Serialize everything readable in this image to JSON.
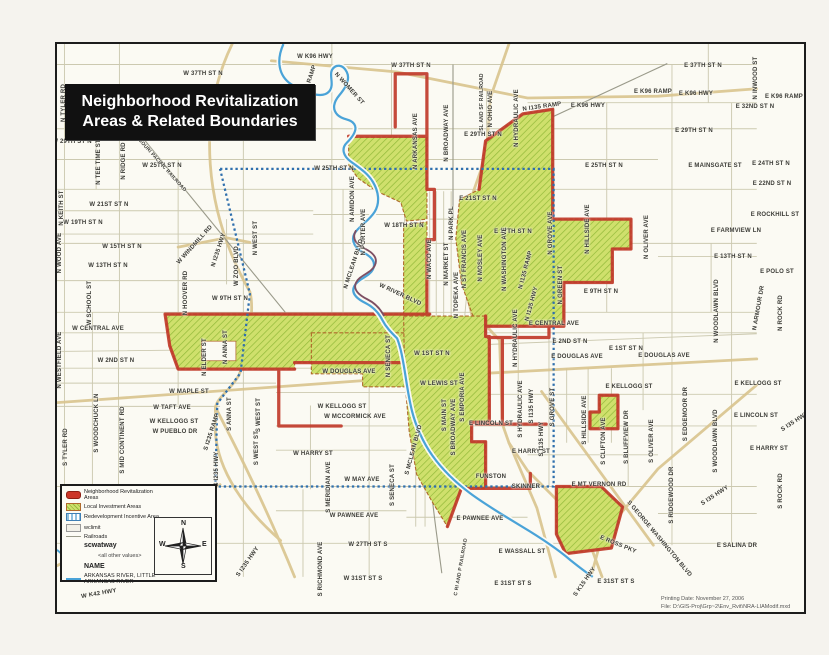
{
  "page": {
    "title_line1": "Neighborhood Revitalization",
    "title_line2": "Areas & Related Boundaries"
  },
  "footer": {
    "line1": "Printing Date: November 27, 2006",
    "line2": "File: D:\\GIS-Proj\\Grp~2\\Env_Rvit\\NRA-LIAModif.mxd"
  },
  "colors": {
    "nra_red": "#c13b2b",
    "lia_green_fill": "#cfe06c",
    "lia_green_hatch": "#96bc3c",
    "ria_blue_dash": "#2f6fad",
    "river_blue": "#4aa3d8",
    "highway_tan": "#d9c48e",
    "railroad_gray": "#9a9a8a"
  },
  "legend": {
    "items": [
      {
        "swatch": "nra",
        "label": "Neighborhood Revitalization Areas"
      },
      {
        "swatch": "lia",
        "label": "Local Investment Areas"
      },
      {
        "swatch": "ria",
        "label": "Redevelopment Incentive Area"
      },
      {
        "swatch": "limit",
        "label": "wclimit"
      },
      {
        "swatch": "rail",
        "label": "Railroads"
      },
      {
        "swatch": "none",
        "label": "scwatway",
        "bold": true
      },
      {
        "swatch": "none",
        "label": "<all other values>",
        "indent": true
      },
      {
        "swatch": "none",
        "label": "NAME",
        "bold": true
      },
      {
        "swatch": "river",
        "label": "ARKANSAS RIVER, LITTLE ARKANSAS RIVER",
        "caps": true
      }
    ],
    "compass": {
      "n": "N",
      "s": "S",
      "e": "E",
      "w": "W"
    }
  },
  "map_labels": [
    {
      "t": "W 37TH ST N",
      "x": 201,
      "y": 72
    },
    {
      "t": "W 37TH ST N",
      "x": 409,
      "y": 64
    },
    {
      "t": "E 37TH ST N",
      "x": 701,
      "y": 64
    },
    {
      "t": "W 29TH ST N",
      "x": 70,
      "y": 140
    },
    {
      "t": "W 29TH ST N",
      "x": 191,
      "y": 138
    },
    {
      "t": "E 29TH ST N",
      "x": 481,
      "y": 133
    },
    {
      "t": "E 29TH ST N",
      "x": 692,
      "y": 129
    },
    {
      "t": "E 32ND ST N",
      "x": 753,
      "y": 105
    },
    {
      "t": "E K96 RAMP",
      "x": 651,
      "y": 90
    },
    {
      "t": "E K96 RAMP",
      "x": 782,
      "y": 95
    },
    {
      "t": "E K96 HWY",
      "x": 694,
      "y": 92
    },
    {
      "t": "E K96 HWY",
      "x": 586,
      "y": 104
    },
    {
      "t": "W K96 HWY",
      "x": 313,
      "y": 55
    },
    {
      "t": "W 25TH ST N",
      "x": 160,
      "y": 164
    },
    {
      "t": "W 25TH ST N",
      "x": 332,
      "y": 167
    },
    {
      "t": "E 25TH ST N",
      "x": 602,
      "y": 164
    },
    {
      "t": "E MAINSGATE ST",
      "x": 713,
      "y": 164
    },
    {
      "t": "E 24TH ST N",
      "x": 769,
      "y": 162
    },
    {
      "t": "E 22ND ST N",
      "x": 770,
      "y": 182
    },
    {
      "t": "E ROCKHILL ST",
      "x": 773,
      "y": 213
    },
    {
      "t": "W 21ST ST N",
      "x": 107,
      "y": 203
    },
    {
      "t": "E 21ST ST N",
      "x": 476,
      "y": 197
    },
    {
      "t": "W 19TH ST N",
      "x": 81,
      "y": 221
    },
    {
      "t": "W 18TH ST N",
      "x": 402,
      "y": 224
    },
    {
      "t": "E 17TH ST N",
      "x": 511,
      "y": 230
    },
    {
      "t": "E FARMVIEW LN",
      "x": 734,
      "y": 229
    },
    {
      "t": "W 15TH ST N",
      "x": 120,
      "y": 245
    },
    {
      "t": "W 13TH ST N",
      "x": 106,
      "y": 264
    },
    {
      "t": "E 13TH ST N",
      "x": 731,
      "y": 255
    },
    {
      "t": "E POLO ST",
      "x": 775,
      "y": 270
    },
    {
      "t": "W 9TH ST N",
      "x": 228,
      "y": 297
    },
    {
      "t": "E 9TH ST N",
      "x": 599,
      "y": 290
    },
    {
      "t": "W CENTRAL AVE",
      "x": 96,
      "y": 327
    },
    {
      "t": "E CENTRAL AVE",
      "x": 552,
      "y": 322
    },
    {
      "t": "W 2ND ST N",
      "x": 114,
      "y": 359
    },
    {
      "t": "E 2ND ST N",
      "x": 568,
      "y": 340
    },
    {
      "t": "W 1ST ST N",
      "x": 430,
      "y": 352
    },
    {
      "t": "E 1ST ST N",
      "x": 624,
      "y": 347
    },
    {
      "t": "W DOUGLAS AVE",
      "x": 347,
      "y": 370
    },
    {
      "t": "E DOUGLAS AVE",
      "x": 575,
      "y": 355
    },
    {
      "t": "E DOUGLAS AVE",
      "x": 662,
      "y": 354
    },
    {
      "t": "W LEWIS ST",
      "x": 437,
      "y": 382
    },
    {
      "t": "W MAPLE ST",
      "x": 187,
      "y": 390
    },
    {
      "t": "W TAFT AVE",
      "x": 170,
      "y": 406
    },
    {
      "t": "W KELLOGG ST",
      "x": 172,
      "y": 420
    },
    {
      "t": "W KELLOGG ST",
      "x": 340,
      "y": 405
    },
    {
      "t": "E KELLOGG ST",
      "x": 627,
      "y": 385
    },
    {
      "t": "E KELLOGG ST",
      "x": 756,
      "y": 382
    },
    {
      "t": "W MCCORMICK AVE",
      "x": 353,
      "y": 415
    },
    {
      "t": "W PUEBLO DR",
      "x": 173,
      "y": 430
    },
    {
      "t": "E LINCOLN ST",
      "x": 489,
      "y": 422
    },
    {
      "t": "E LINCOLN ST",
      "x": 754,
      "y": 414
    },
    {
      "t": "W HARRY ST",
      "x": 311,
      "y": 452
    },
    {
      "t": "E HARRY ST",
      "x": 529,
      "y": 450
    },
    {
      "t": "E HARRY ST",
      "x": 767,
      "y": 447
    },
    {
      "t": "FUNSTON",
      "x": 489,
      "y": 475
    },
    {
      "t": "SKINNER",
      "x": 524,
      "y": 485
    },
    {
      "t": "W MAY AVE",
      "x": 360,
      "y": 478
    },
    {
      "t": "E MT VERNON RD",
      "x": 597,
      "y": 483
    },
    {
      "t": "W PAWNEE AVE",
      "x": 352,
      "y": 514
    },
    {
      "t": "E PAWNEE AVE",
      "x": 478,
      "y": 517
    },
    {
      "t": "W 27TH ST S",
      "x": 366,
      "y": 543
    },
    {
      "t": "E WASSALL ST",
      "x": 520,
      "y": 550
    },
    {
      "t": "E SALINA DR",
      "x": 735,
      "y": 544
    },
    {
      "t": "W 31ST ST S",
      "x": 361,
      "y": 577
    },
    {
      "t": "E 31ST ST S",
      "x": 511,
      "y": 582
    },
    {
      "t": "E 31ST ST S",
      "x": 614,
      "y": 580
    },
    {
      "t": "N TYLER RD",
      "x": 62,
      "y": 101,
      "r": -90
    },
    {
      "t": "N KEITH ST",
      "x": 60,
      "y": 206,
      "r": -90
    },
    {
      "t": "N RIDGE RD",
      "x": 122,
      "y": 159,
      "r": -90
    },
    {
      "t": "N TEE TIME ST",
      "x": 97,
      "y": 160,
      "r": -90
    },
    {
      "t": "N WOOD AVE",
      "x": 58,
      "y": 251,
      "r": -90
    },
    {
      "t": "W SCHOOL ST",
      "x": 88,
      "y": 301,
      "r": -90
    },
    {
      "t": "N WESTFIELD AVE",
      "x": 58,
      "y": 358,
      "r": -90
    },
    {
      "t": "N HOOVER RD",
      "x": 184,
      "y": 291,
      "r": -90
    },
    {
      "t": "W ZOO BLVD",
      "x": 235,
      "y": 264,
      "r": -90
    },
    {
      "t": "N WEST ST",
      "x": 254,
      "y": 236,
      "r": -90
    },
    {
      "t": "S WEST ST",
      "x": 257,
      "y": 413,
      "r": -90
    },
    {
      "t": "S WEST ST",
      "x": 255,
      "y": 446,
      "r": -90
    },
    {
      "t": "N AMIDON AVE",
      "x": 351,
      "y": 197,
      "r": -90
    },
    {
      "t": "N PORTER AVE",
      "x": 362,
      "y": 230,
      "r": -90
    },
    {
      "t": "N ARKANSAS AVE",
      "x": 414,
      "y": 139,
      "r": -90
    },
    {
      "t": "N BROADWAY AVE",
      "x": 445,
      "y": 131,
      "r": -90
    },
    {
      "t": "N WACO AVE",
      "x": 428,
      "y": 257,
      "r": -90
    },
    {
      "t": "N MARKET ST",
      "x": 445,
      "y": 262,
      "r": -90
    },
    {
      "t": "N PARK PL",
      "x": 450,
      "y": 221,
      "r": -90
    },
    {
      "t": "N TOPEKA AVE",
      "x": 455,
      "y": 293,
      "r": -90
    },
    {
      "t": "N ST FRANCIS AVE",
      "x": 463,
      "y": 257,
      "r": -90
    },
    {
      "t": "N MOSLEY AVE",
      "x": 479,
      "y": 256,
      "r": -90
    },
    {
      "t": "N WASHINGTON AVE",
      "x": 503,
      "y": 257,
      "r": -90
    },
    {
      "t": "N OHIO AVE",
      "x": 489,
      "y": 107,
      "r": -90
    },
    {
      "t": "SL AND SF RAILROAD",
      "x": 480,
      "y": 100,
      "r": -90,
      "s": 5
    },
    {
      "t": "N HYDRAULIC AVE",
      "x": 515,
      "y": 116,
      "r": -90
    },
    {
      "t": "N HYDRAULIC AVE",
      "x": 514,
      "y": 336,
      "r": -90
    },
    {
      "t": "S HYDRAULIC AVE",
      "x": 519,
      "y": 407,
      "r": -90
    },
    {
      "t": "N GROVE AVE",
      "x": 549,
      "y": 231,
      "r": -90
    },
    {
      "t": "N GREEN ST",
      "x": 559,
      "y": 283,
      "r": -90
    },
    {
      "t": "N HILLSIDE AVE",
      "x": 586,
      "y": 227,
      "r": -90
    },
    {
      "t": "S HILLSIDE AVE",
      "x": 583,
      "y": 418,
      "r": -90
    },
    {
      "t": "N OLIVER AVE",
      "x": 645,
      "y": 235,
      "r": -90
    },
    {
      "t": "S OLIVER AVE",
      "x": 650,
      "y": 439,
      "r": -90
    },
    {
      "t": "S CLIFTON AVE",
      "x": 602,
      "y": 439,
      "r": -90
    },
    {
      "t": "S BLUFFVIEW DR",
      "x": 625,
      "y": 435,
      "r": -90
    },
    {
      "t": "S EDGEMOOR DR",
      "x": 684,
      "y": 412,
      "r": -90
    },
    {
      "t": "S RIDGEWOOD DR",
      "x": 670,
      "y": 493,
      "r": -90
    },
    {
      "t": "N WOODLAWN BLVD",
      "x": 715,
      "y": 309,
      "r": -90
    },
    {
      "t": "S WOODLAWN BLVD",
      "x": 714,
      "y": 439,
      "r": -90
    },
    {
      "t": "N ARMOUR DR",
      "x": 757,
      "y": 306,
      "r": -80
    },
    {
      "t": "N ROCK RD",
      "x": 779,
      "y": 311,
      "r": -90
    },
    {
      "t": "S ROCK RD",
      "x": 779,
      "y": 489,
      "r": -90
    },
    {
      "t": "N INWOOD ST",
      "x": 754,
      "y": 76,
      "r": -90
    },
    {
      "t": "S MERIDIAN AVE",
      "x": 327,
      "y": 485,
      "r": -90
    },
    {
      "t": "S RICHMOND AVE",
      "x": 319,
      "y": 567,
      "r": -90
    },
    {
      "t": "S SENECA ST",
      "x": 391,
      "y": 483,
      "r": -90
    },
    {
      "t": "N SENECA ST",
      "x": 387,
      "y": 354,
      "r": -90
    },
    {
      "t": "S MAIN ST",
      "x": 443,
      "y": 413,
      "r": -90
    },
    {
      "t": "S BROADWAY AVE",
      "x": 452,
      "y": 425,
      "r": -90
    },
    {
      "t": "S EMPORIA AVE",
      "x": 461,
      "y": 395,
      "r": -90
    },
    {
      "t": "S MCLEAN BLVD",
      "x": 412,
      "y": 448,
      "r": -75
    },
    {
      "t": "N MCLEAN BLVD",
      "x": 352,
      "y": 262,
      "r": -72
    },
    {
      "t": "N ELDER ST",
      "x": 203,
      "y": 355,
      "r": -90
    },
    {
      "t": "N ANNA ST",
      "x": 224,
      "y": 345,
      "r": -90
    },
    {
      "t": "S ANNA ST",
      "x": 228,
      "y": 412,
      "r": -90
    },
    {
      "t": "S MID CONTINENT RD",
      "x": 121,
      "y": 438,
      "r": -90
    },
    {
      "t": "S WOODCHUCK LN",
      "x": 95,
      "y": 421,
      "r": -90
    },
    {
      "t": "S TYLER RD",
      "x": 64,
      "y": 445,
      "r": -90
    },
    {
      "t": "S I235 HWY",
      "x": 215,
      "y": 467,
      "r": -90
    },
    {
      "t": "S I235 RAMP",
      "x": 210,
      "y": 430,
      "r": -72
    },
    {
      "t": "S I235 HWY",
      "x": 246,
      "y": 560,
      "r": -55
    },
    {
      "t": "S I135 HWY",
      "x": 530,
      "y": 404,
      "r": -90
    },
    {
      "t": "S I135 HWY",
      "x": 540,
      "y": 437,
      "r": -90
    },
    {
      "t": "N I135 HWY",
      "x": 530,
      "y": 302,
      "r": -75
    },
    {
      "t": "N I135 RAMP",
      "x": 524,
      "y": 268,
      "r": -75
    },
    {
      "t": "N I135 RAMP",
      "x": 540,
      "y": 105,
      "r": -8
    },
    {
      "t": "S GROVE ST",
      "x": 551,
      "y": 405,
      "r": -90
    },
    {
      "t": "MISSOURI PACIFIC RAILROAD",
      "x": 157,
      "y": 160,
      "r": 48,
      "s": 5
    },
    {
      "t": "W WINDMILL RD",
      "x": 193,
      "y": 243,
      "r": -48
    },
    {
      "t": "N I235 HWY",
      "x": 217,
      "y": 248,
      "r": -72
    },
    {
      "t": "N I235 RAMP",
      "x": 307,
      "y": 82,
      "r": -72
    },
    {
      "t": "N WOMER ST",
      "x": 347,
      "y": 87,
      "r": 48
    },
    {
      "t": "W RIVER BLVD",
      "x": 398,
      "y": 293,
      "r": 25
    },
    {
      "t": "C RI AND P RAILROAD",
      "x": 459,
      "y": 565,
      "r": -80,
      "s": 5
    },
    {
      "t": "W K42 HWY",
      "x": 97,
      "y": 592,
      "r": -10
    },
    {
      "t": "S K15 HWY",
      "x": 583,
      "y": 580,
      "r": -55
    },
    {
      "t": "E ROSS PKY",
      "x": 616,
      "y": 543,
      "r": 22
    },
    {
      "t": "S GEORGE WASHINGTON BLVD",
      "x": 657,
      "y": 537,
      "r": 50
    },
    {
      "t": "S I35 HWY",
      "x": 793,
      "y": 420,
      "r": -33
    },
    {
      "t": "S I35 HWY",
      "x": 713,
      "y": 494,
      "r": -33
    }
  ]
}
